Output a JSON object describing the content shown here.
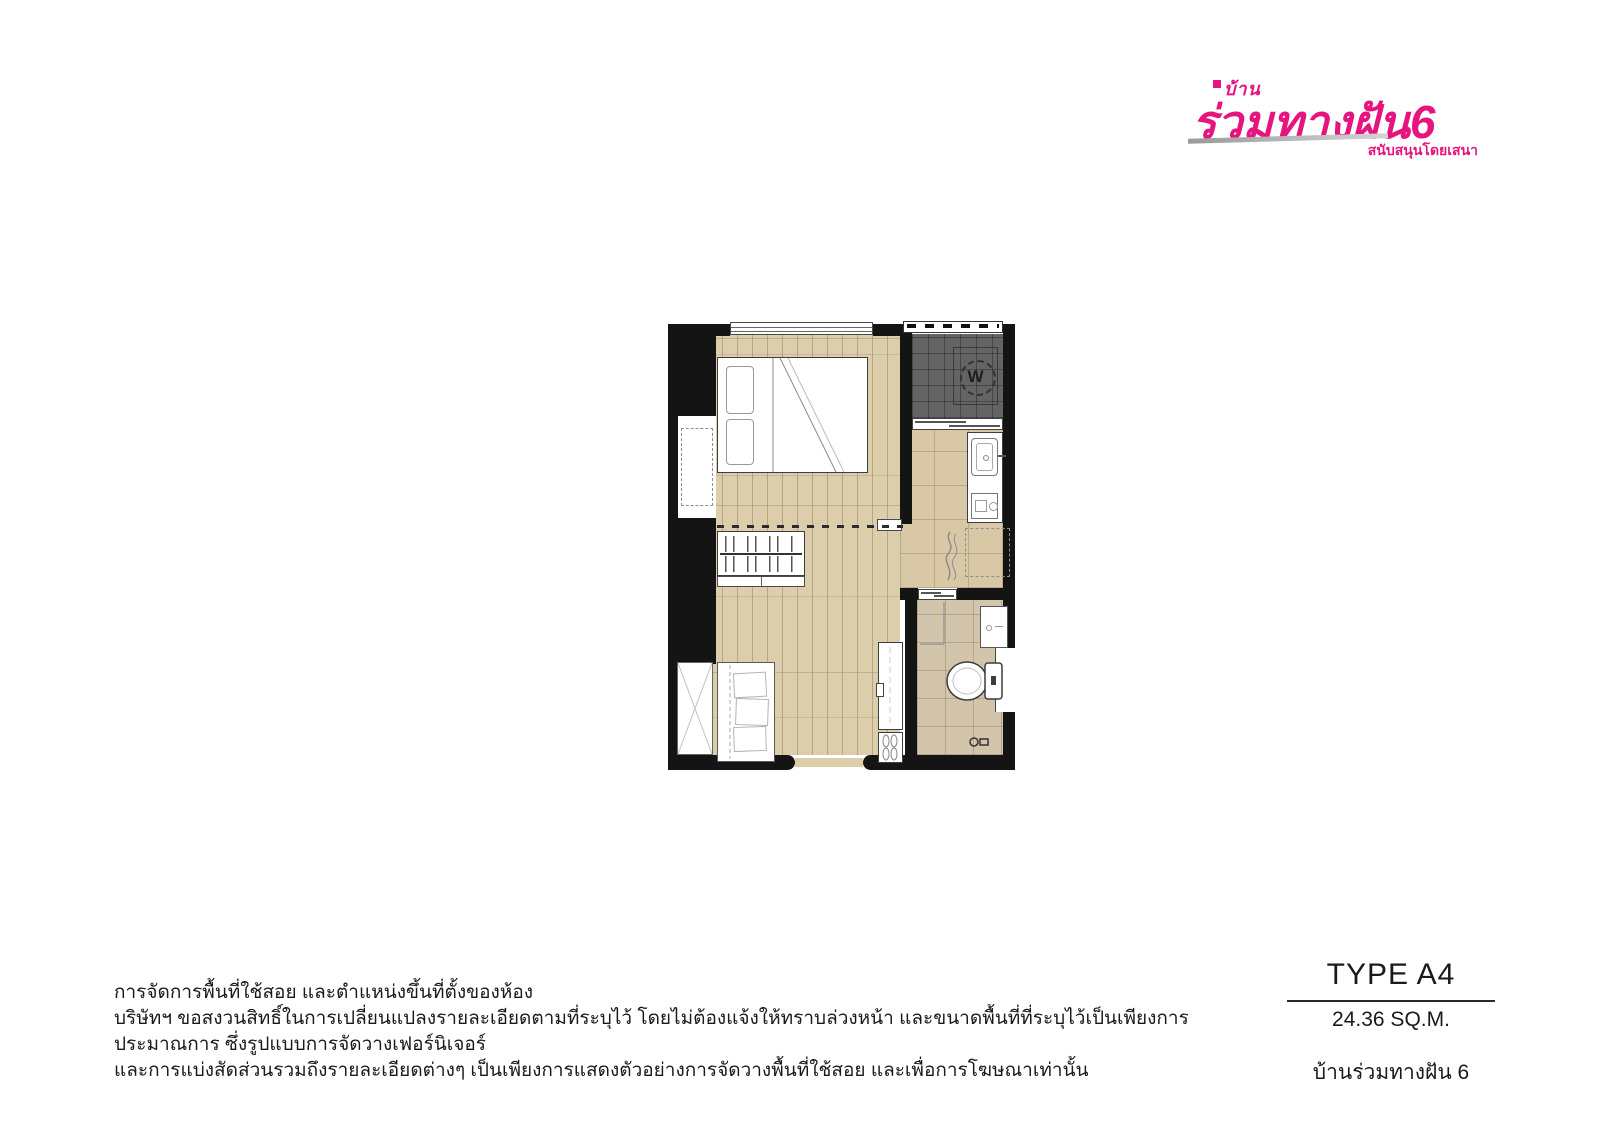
{
  "logo": {
    "brand_top": "บ้าน",
    "brand_main": "ร่วมทางฝัน6",
    "brand_sub": "สนับสนุนโดยเสนา",
    "accent_color": "#e6147e"
  },
  "plan": {
    "washer_label": "W",
    "colors": {
      "wall": "#141414",
      "wood_floor": "#dccdab",
      "kitchen_tile": "#d8c8a6",
      "bathroom_tile": "#d2c5ab",
      "balcony_tile": "#646464"
    }
  },
  "disclaimer": {
    "line1": "การจัดการพื้นที่ใช้สอย และตำแหน่งขึ้นที่ตั้งของห้อง",
    "line2": "บริษัทฯ ขอสงวนสิทธิ์ในการเปลี่ยนแปลงรายละเอียดตามที่ระบุไว้ โดยไม่ต้องแจ้งให้ทราบล่วงหน้า และขนาดพื้นที่ที่ระบุไว้เป็นเพียงการประมาณการ ซึ่งรูปแบบการจัดวางเฟอร์นิเจอร์",
    "line3": "และการแบ่งสัดส่วนรวมถึงรายละเอียดต่างๆ เป็นเพียงการแสดงตัวอย่างการจัดวางพื้นที่ใช้สอย และเพื่อการโฆษณาเท่านั้น"
  },
  "unit": {
    "type_label": "TYPE A4",
    "area_label": "24.36 SQ.M.",
    "project_name": "บ้านร่วมทางฝัน 6"
  }
}
